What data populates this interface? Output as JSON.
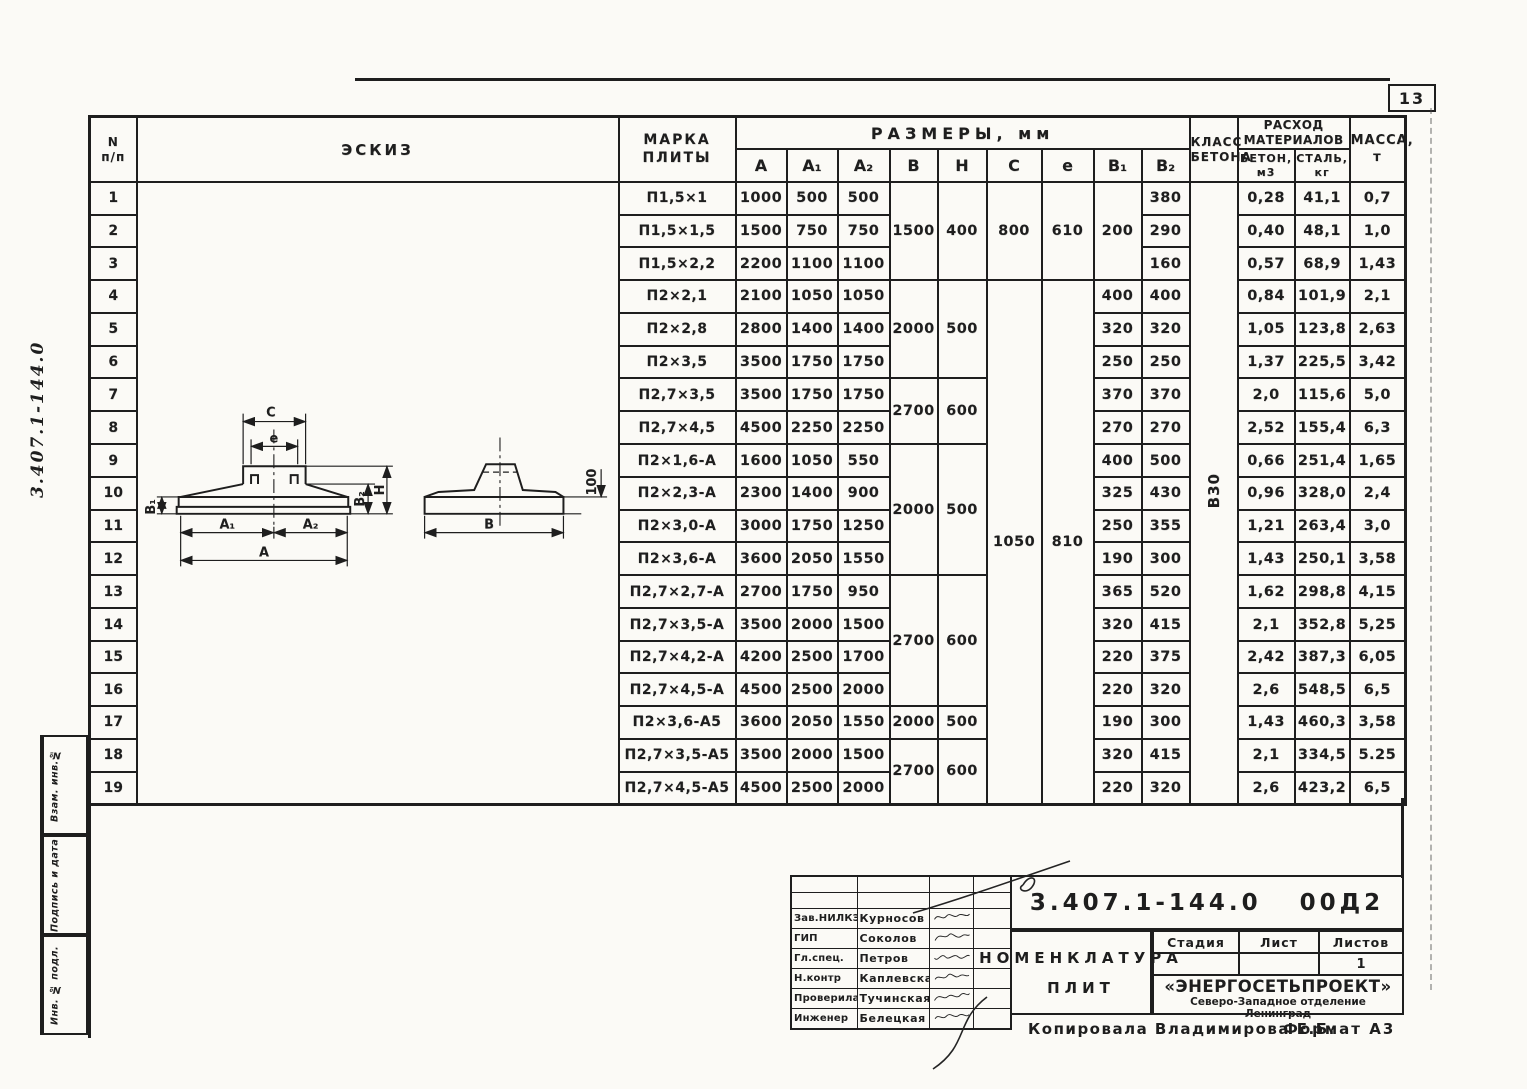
{
  "page": {
    "number": "13",
    "footer_copied": "Копировала Владимирова Е.Б.",
    "footer_format": "Формат А3"
  },
  "frame": {
    "side_doc_number": "3.407.1-144.0",
    "stamp_labels": {
      "s1": "Взам. инв.№",
      "s2": "Подпись и дата",
      "s3": "Инв. № подл."
    }
  },
  "table": {
    "headers": {
      "num_top": "N",
      "num_bottom": "п/п",
      "sketch": "ЭСКИЗ",
      "mark_1": "МАРКА",
      "mark_2": "ПЛИТЫ",
      "dims": "РАЗМЕРЫ, мм",
      "a": "А",
      "a1": "А₁",
      "a2": "А₂",
      "b": "В",
      "h": "Н",
      "c": "С",
      "e": "е",
      "b1": "В₁",
      "b2": "В₂",
      "class_1": "КЛАСС",
      "class_2": "БЕТОНА",
      "materials_1": "РАСХОД",
      "materials_2": "МАТЕРИАЛОВ",
      "concrete_1": "БЕТОН,",
      "concrete_2": "м3",
      "steel_1": "СТАЛЬ,",
      "steel_2": "кг",
      "mass_1": "МАССА,",
      "mass_2": "т"
    },
    "concrete_class": "В30",
    "rows": [
      {
        "num": "1",
        "mark": "П1,5×1",
        "a": "1000",
        "a1": "500",
        "a2": "500",
        "b": "1500",
        "h": "400",
        "c": "800",
        "e": "610",
        "b1": "200",
        "b2": "380",
        "concrete": "0,28",
        "steel": "41,1",
        "mass": "0,7"
      },
      {
        "num": "2",
        "mark": "П1,5×1,5",
        "a": "1500",
        "a1": "750",
        "a2": "750",
        "b2": "290",
        "concrete": "0,40",
        "steel": "48,1",
        "mass": "1,0"
      },
      {
        "num": "3",
        "mark": "П1,5×2,2",
        "a": "2200",
        "a1": "1100",
        "a2": "1100",
        "b2": "160",
        "concrete": "0,57",
        "steel": "68,9",
        "mass": "1,43"
      },
      {
        "num": "4",
        "mark": "П2×2,1",
        "a": "2100",
        "a1": "1050",
        "a2": "1050",
        "b": "2000",
        "h": "500",
        "c": "1050",
        "e": "810",
        "b1": "400",
        "b2": "400",
        "concrete": "0,84",
        "steel": "101,9",
        "mass": "2,1"
      },
      {
        "num": "5",
        "mark": "П2×2,8",
        "a": "2800",
        "a1": "1400",
        "a2": "1400",
        "b1": "320",
        "b2": "320",
        "concrete": "1,05",
        "steel": "123,8",
        "mass": "2,63"
      },
      {
        "num": "6",
        "mark": "П2×3,5",
        "a": "3500",
        "a1": "1750",
        "a2": "1750",
        "b1": "250",
        "b2": "250",
        "concrete": "1,37",
        "steel": "225,5",
        "mass": "3,42"
      },
      {
        "num": "7",
        "mark": "П2,7×3,5",
        "a": "3500",
        "a1": "1750",
        "a2": "1750",
        "b": "2700",
        "h": "600",
        "b1": "370",
        "b2": "370",
        "concrete": "2,0",
        "steel": "115,6",
        "mass": "5,0"
      },
      {
        "num": "8",
        "mark": "П2,7×4,5",
        "a": "4500",
        "a1": "2250",
        "a2": "2250",
        "b1": "270",
        "b2": "270",
        "concrete": "2,52",
        "steel": "155,4",
        "mass": "6,3"
      },
      {
        "num": "9",
        "mark": "П2×1,6-А",
        "a": "1600",
        "a1": "1050",
        "a2": "550",
        "b": "2000",
        "h": "500",
        "b1": "400",
        "b2": "500",
        "concrete": "0,66",
        "steel": "251,4",
        "mass": "1,65"
      },
      {
        "num": "10",
        "mark": "П2×2,3-А",
        "a": "2300",
        "a1": "1400",
        "a2": "900",
        "b1": "325",
        "b2": "430",
        "concrete": "0,96",
        "steel": "328,0",
        "mass": "2,4"
      },
      {
        "num": "11",
        "mark": "П2×3,0-А",
        "a": "3000",
        "a1": "1750",
        "a2": "1250",
        "b1": "250",
        "b2": "355",
        "concrete": "1,21",
        "steel": "263,4",
        "mass": "3,0"
      },
      {
        "num": "12",
        "mark": "П2×3,6-А",
        "a": "3600",
        "a1": "2050",
        "a2": "1550",
        "b1": "190",
        "b2": "300",
        "concrete": "1,43",
        "steel": "250,1",
        "mass": "3,58"
      },
      {
        "num": "13",
        "mark": "П2,7×2,7-А",
        "a": "2700",
        "a1": "1750",
        "a2": "950",
        "b": "2700",
        "h": "600",
        "b1": "365",
        "b2": "520",
        "concrete": "1,62",
        "steel": "298,8",
        "mass": "4,15"
      },
      {
        "num": "14",
        "mark": "П2,7×3,5-А",
        "a": "3500",
        "a1": "2000",
        "a2": "1500",
        "b1": "320",
        "b2": "415",
        "concrete": "2,1",
        "steel": "352,8",
        "mass": "5,25"
      },
      {
        "num": "15",
        "mark": "П2,7×4,2-А",
        "a": "4200",
        "a1": "2500",
        "a2": "1700",
        "b1": "220",
        "b2": "375",
        "concrete": "2,42",
        "steel": "387,3",
        "mass": "6,05"
      },
      {
        "num": "16",
        "mark": "П2,7×4,5-А",
        "a": "4500",
        "a1": "2500",
        "a2": "2000",
        "b1": "220",
        "b2": "320",
        "concrete": "2,6",
        "steel": "548,5",
        "mass": "6,5"
      },
      {
        "num": "17",
        "mark": "П2×3,6-А5",
        "a": "3600",
        "a1": "2050",
        "a2": "1550",
        "b": "2000",
        "h": "500",
        "b1": "190",
        "b2": "300",
        "concrete": "1,43",
        "steel": "460,3",
        "mass": "3,58"
      },
      {
        "num": "18",
        "mark": "П2,7×3,5-А5",
        "a": "3500",
        "a1": "2000",
        "a2": "1500",
        "b": "2700",
        "h": "600",
        "b1": "320",
        "b2": "415",
        "concrete": "2,1",
        "steel": "334,5",
        "mass": "5.25"
      },
      {
        "num": "19",
        "mark": "П2,7×4,5-А5",
        "a": "4500",
        "a1": "2500",
        "a2": "2000",
        "b1": "220",
        "b2": "320",
        "concrete": "2,6",
        "steel": "423,2",
        "mass": "6,5"
      }
    ]
  },
  "sketch": {
    "labels": {
      "c": "С",
      "e": "е",
      "b1": "В₁",
      "b2": "В₂",
      "h": "Н",
      "a1": "А₁",
      "a2": "А₂",
      "a": "А",
      "b": "В",
      "lip": "100"
    }
  },
  "titleblock": {
    "doc_number": "3.407.1-144.0",
    "doc_code": "00Д2",
    "title_line1": "НОМЕНКЛАТУРА",
    "title_line2": "ПЛИТ",
    "signers": [
      {
        "role": "Зав.НИЛКЭ",
        "name": "Курносов"
      },
      {
        "role": "ГИП",
        "name": "Соколов"
      },
      {
        "role": "Гл.спец.",
        "name": "Петров"
      },
      {
        "role": "Н.контр",
        "name": "Каплевская"
      },
      {
        "role": "Проверила",
        "name": "Тучинская"
      },
      {
        "role": "Инженер",
        "name": "Белецкая"
      }
    ],
    "stage_label": "Стадия",
    "sheet_label": "Лист",
    "sheets_label": "Листов",
    "sheets_value": "1",
    "org_name": "«ЭНЕРГОСЕТЬПРОЕКТ»",
    "org_branch": "Северо-Западное отделение",
    "org_city": "Ленинград"
  }
}
